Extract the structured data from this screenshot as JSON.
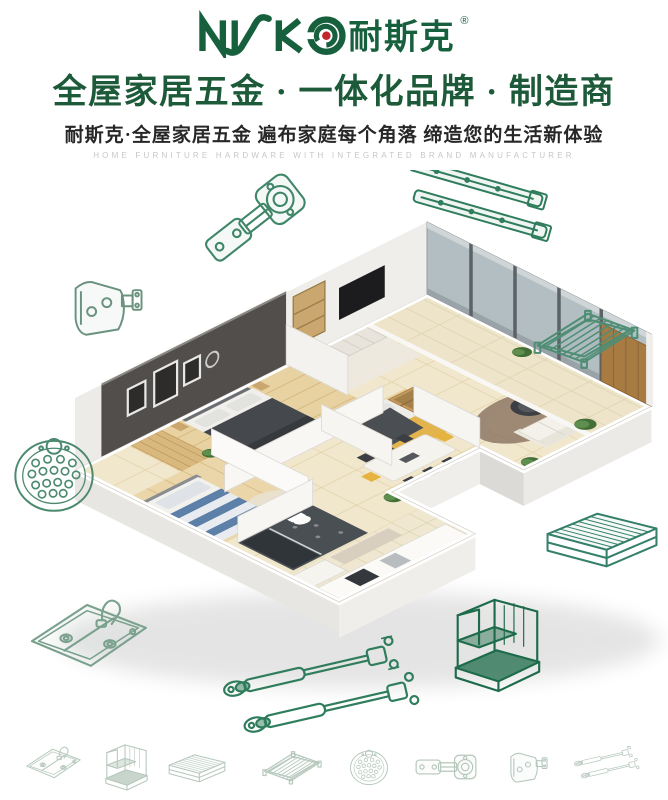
{
  "brand": {
    "logo_latin": "NISKO",
    "logo_cn": "耐斯克",
    "registered": "®",
    "green": "#17603e",
    "dot_red": "#c1272d"
  },
  "header": {
    "headline": "全屋家居五金 · 一体化品牌 · 制造商",
    "subheadline": "耐斯克·全屋家居五金 遍布家庭每个角落 缔造您的生活新体验",
    "tagline_en": "HOME FURNITURE HARDWARE WITH INTEGRATED BRAND MANUFACTURER",
    "headline_color": "#1d5a39"
  },
  "hero": {
    "description": "3D isometric cutaway rendering of a furnished apartment",
    "rooms": [
      "master-bedroom",
      "kids-bedroom",
      "bedroom",
      "bathroom",
      "kitchen",
      "dining-area",
      "living-room",
      "balcony"
    ],
    "hardware_icons": [
      "concealed-hinge",
      "ball-bearing-drawer-slides",
      "wire-shelf",
      "cabinet-bracket",
      "perforated-plate",
      "double-bowl-sink",
      "gas-lift-struts",
      "wire-storage-rack",
      "wire-basket-drawer"
    ]
  },
  "bottom_icons": [
    "double-bowl-sink",
    "wire-storage-rack",
    "wire-basket-drawer",
    "wire-shelf",
    "perforated-plate",
    "concealed-hinge",
    "cabinet-bracket",
    "gas-lift-struts"
  ],
  "colors": {
    "line_art_green": "#2f7d5c",
    "light_line_art": "#b5c7bb"
  }
}
